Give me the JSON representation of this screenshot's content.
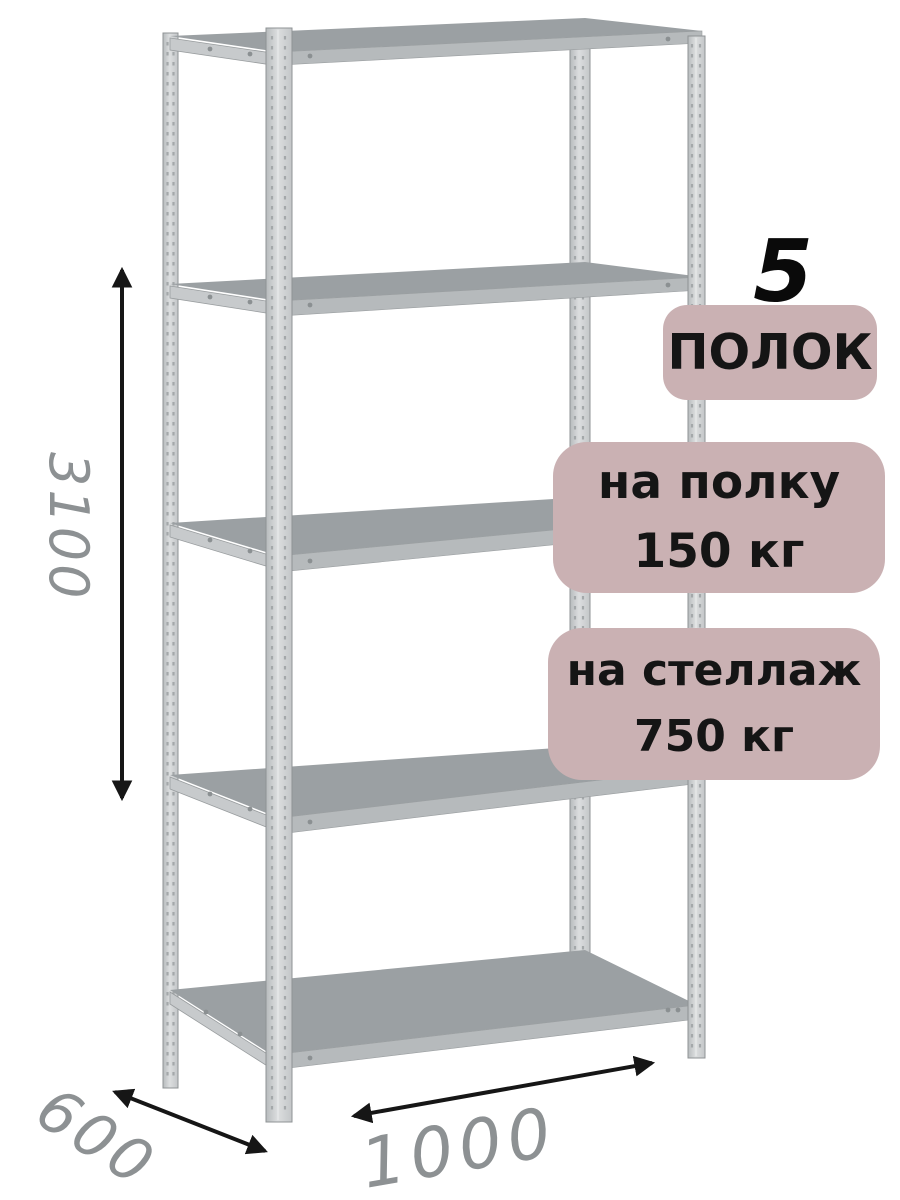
{
  "badges": {
    "count_number": "5",
    "count_label": "ПОЛОК",
    "per_shelf": {
      "line1": "на полку",
      "line2": "150 кг"
    },
    "per_rack": {
      "line1": "на стеллаж",
      "line2": "750 кг"
    }
  },
  "dimensions": {
    "height": "3100",
    "depth": "600",
    "width": "1000"
  },
  "colors": {
    "badge_bg": "#cab1b3",
    "badge_text": "#151515",
    "dimension_text": "#8d9193",
    "arrow": "#161616",
    "shelf_top": "#9ba0a3",
    "shelf_front": "#b6babc",
    "post": "#c9ccce",
    "background": "#ffffff"
  }
}
